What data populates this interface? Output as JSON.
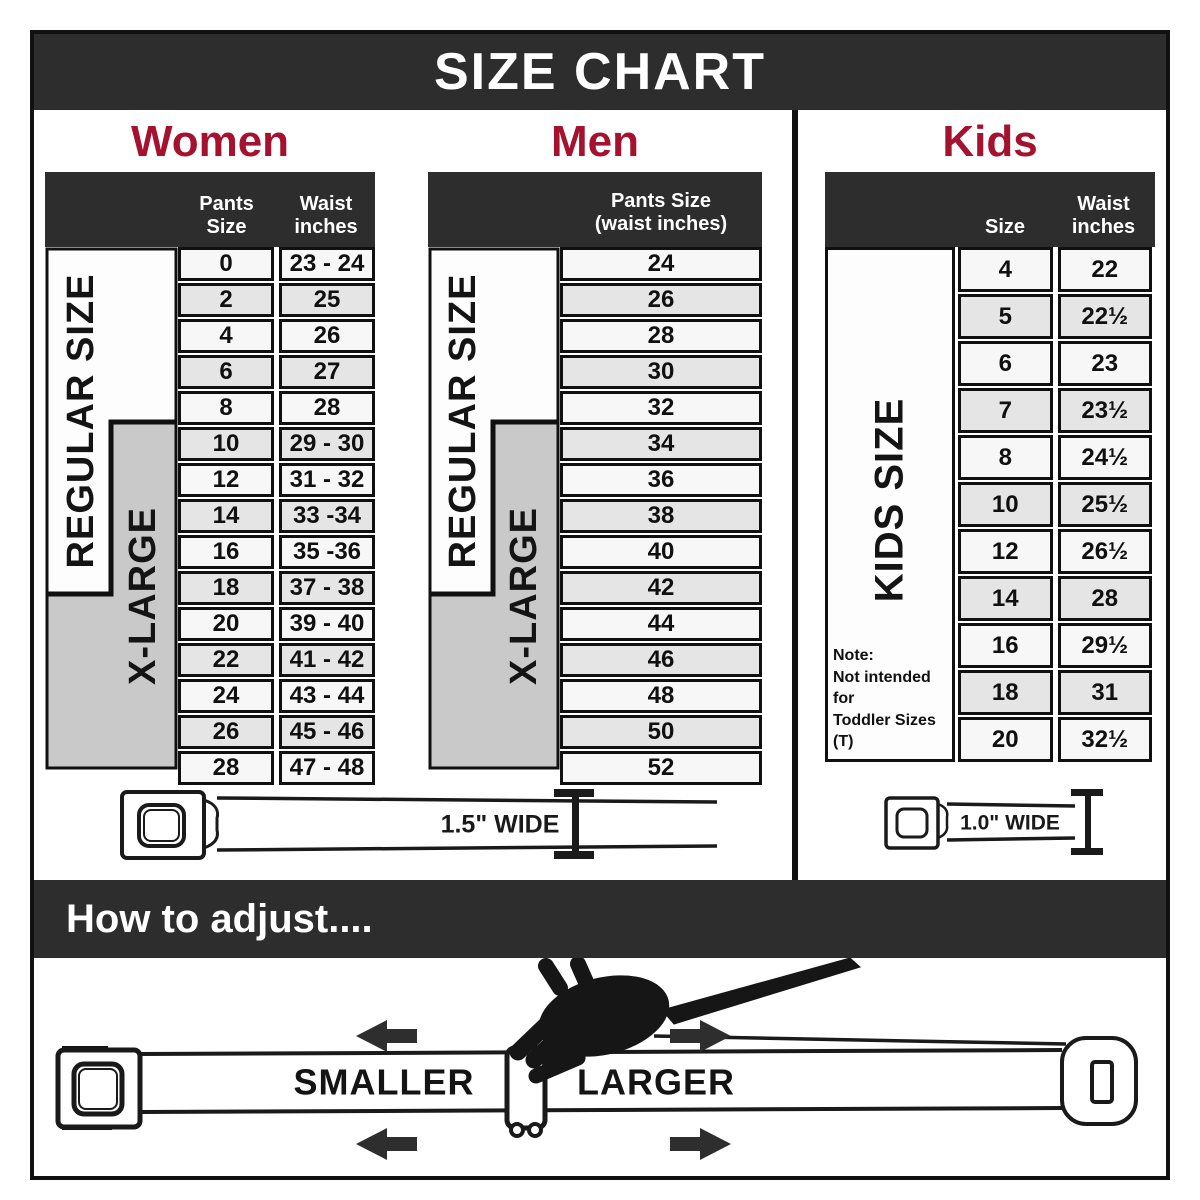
{
  "title": "SIZE CHART",
  "colors": {
    "bar_background": "#2d2d2d",
    "accent_heading": "#a5122f",
    "row_light": "#f7f7f7",
    "row_shaded": "#e5e5e5",
    "xlarge_gray": "#c9c9c9",
    "border": "#101010"
  },
  "sections": {
    "women": {
      "heading": "Women",
      "col1_header": "Pants Size",
      "col2_header_line1": "Waist",
      "col2_header_line2": "inches",
      "regular_label": "REGULAR SIZE",
      "xlarge_label": "X-LARGE",
      "rows": [
        [
          "0",
          "23 - 24"
        ],
        [
          "2",
          "25"
        ],
        [
          "4",
          "26"
        ],
        [
          "6",
          "27"
        ],
        [
          "8",
          "28"
        ],
        [
          "10",
          "29 - 30"
        ],
        [
          "12",
          "31 - 32"
        ],
        [
          "14",
          "33 -34"
        ],
        [
          "16",
          "35 -36"
        ],
        [
          "18",
          "37 - 38"
        ],
        [
          "20",
          "39 - 40"
        ],
        [
          "22",
          "41 - 42"
        ],
        [
          "24",
          "43 - 44"
        ],
        [
          "26",
          "45 - 46"
        ],
        [
          "28",
          "47 - 48"
        ]
      ]
    },
    "men": {
      "heading": "Men",
      "col_header_line1": "Pants Size",
      "col_header_line2": "(waist inches)",
      "regular_label": "REGULAR SIZE",
      "xlarge_label": "X-LARGE",
      "rows": [
        "24",
        "26",
        "28",
        "30",
        "32",
        "34",
        "36",
        "38",
        "40",
        "42",
        "44",
        "46",
        "48",
        "50",
        "52"
      ]
    },
    "kids": {
      "heading": "Kids",
      "col1_header": "Size",
      "col2_header_line1": "Waist",
      "col2_header_line2": "inches",
      "side_label": "KIDS SIZE",
      "note_line1": "Note:",
      "note_line2": "Not intended for",
      "note_line3": "Toddler Sizes (T)",
      "rows": [
        [
          "4",
          "22"
        ],
        [
          "5",
          "22½"
        ],
        [
          "6",
          "23"
        ],
        [
          "7",
          "23½"
        ],
        [
          "8",
          "24½"
        ],
        [
          "10",
          "25½"
        ],
        [
          "12",
          "26½"
        ],
        [
          "14",
          "28"
        ],
        [
          "16",
          "29½"
        ],
        [
          "18",
          "31"
        ],
        [
          "20",
          "32½"
        ]
      ]
    }
  },
  "belts": {
    "adult_width_label": "1.5\" WIDE",
    "kids_width_label": "1.0\" WIDE"
  },
  "adjust": {
    "heading": "How to adjust....",
    "smaller_label": "SMALLER",
    "larger_label": "LARGER"
  },
  "chart_data": [
    {
      "type": "table",
      "title": "Women",
      "columns": [
        "Pants Size",
        "Waist inches"
      ],
      "rows": [
        [
          "0",
          "23 - 24"
        ],
        [
          "2",
          "25"
        ],
        [
          "4",
          "26"
        ],
        [
          "6",
          "27"
        ],
        [
          "8",
          "28"
        ],
        [
          "10",
          "29 - 30"
        ],
        [
          "12",
          "31 - 32"
        ],
        [
          "14",
          "33 -34"
        ],
        [
          "16",
          "35 -36"
        ],
        [
          "18",
          "37 - 38"
        ],
        [
          "20",
          "39 - 40"
        ],
        [
          "22",
          "41 - 42"
        ],
        [
          "24",
          "43 - 44"
        ],
        [
          "26",
          "45 - 46"
        ],
        [
          "28",
          "47 - 48"
        ]
      ],
      "groups": {
        "REGULAR SIZE": [
          "0",
          "2",
          "4",
          "6",
          "8",
          "10",
          "12",
          "14",
          "16",
          "18"
        ],
        "X-LARGE": [
          "10",
          "12",
          "14",
          "16",
          "18",
          "20",
          "22",
          "24",
          "26",
          "28"
        ]
      },
      "belt_width": "1.5\" WIDE"
    },
    {
      "type": "table",
      "title": "Men",
      "columns": [
        "Pants Size (waist inches)"
      ],
      "rows": [
        [
          "24"
        ],
        [
          "26"
        ],
        [
          "28"
        ],
        [
          "30"
        ],
        [
          "32"
        ],
        [
          "34"
        ],
        [
          "36"
        ],
        [
          "38"
        ],
        [
          "40"
        ],
        [
          "42"
        ],
        [
          "44"
        ],
        [
          "46"
        ],
        [
          "48"
        ],
        [
          "50"
        ],
        [
          "52"
        ]
      ],
      "groups": {
        "REGULAR SIZE": [
          "24",
          "26",
          "28",
          "30",
          "32",
          "34",
          "36",
          "38",
          "40",
          "42"
        ],
        "X-LARGE": [
          "34",
          "36",
          "38",
          "40",
          "42",
          "44",
          "46",
          "48",
          "50",
          "52"
        ]
      },
      "belt_width": "1.5\" WIDE"
    },
    {
      "type": "table",
      "title": "Kids",
      "columns": [
        "Size",
        "Waist inches"
      ],
      "rows": [
        [
          "4",
          "22"
        ],
        [
          "5",
          "22½"
        ],
        [
          "6",
          "23"
        ],
        [
          "7",
          "23½"
        ],
        [
          "8",
          "24½"
        ],
        [
          "10",
          "25½"
        ],
        [
          "12",
          "26½"
        ],
        [
          "14",
          "28"
        ],
        [
          "16",
          "29½"
        ],
        [
          "18",
          "31"
        ],
        [
          "20",
          "32½"
        ]
      ],
      "groups": {
        "KIDS SIZE": [
          "4",
          "5",
          "6",
          "7",
          "8",
          "10",
          "12",
          "14",
          "16",
          "18",
          "20"
        ]
      },
      "note": "Note: Not intended for Toddler Sizes (T)",
      "belt_width": "1.0\" WIDE"
    }
  ]
}
